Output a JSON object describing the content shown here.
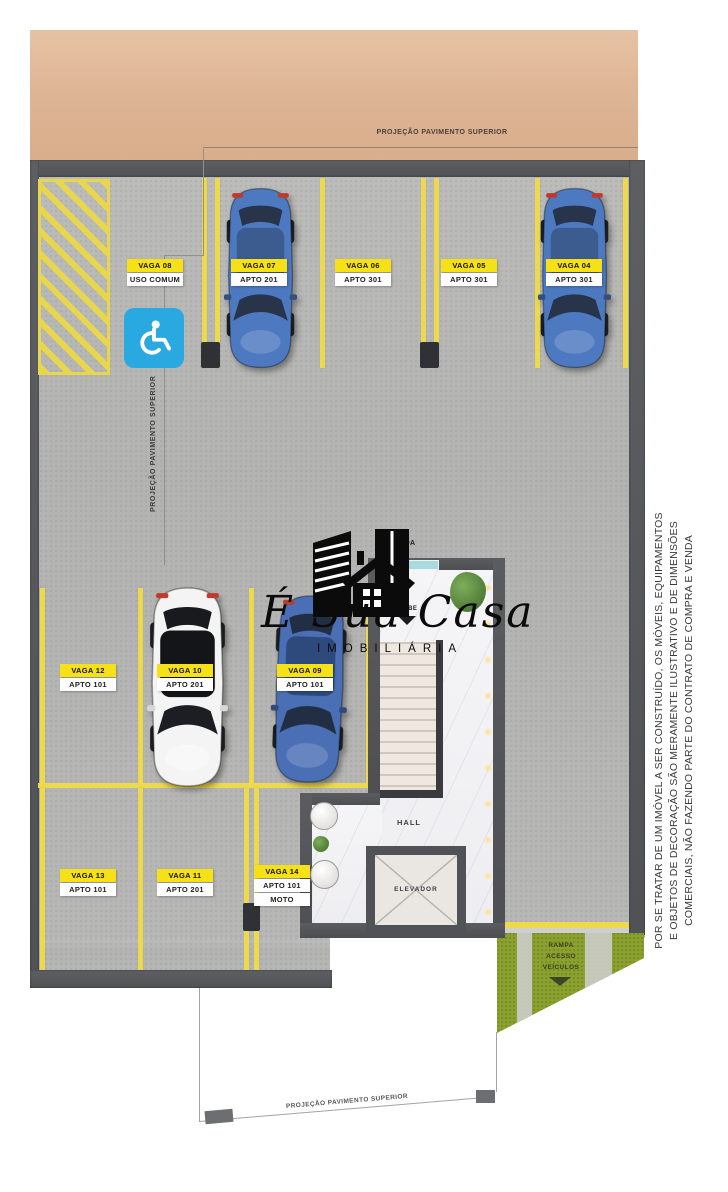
{
  "palette": {
    "sidewalk_tan": "#ddb493",
    "floor_gray": "#b6b7b5",
    "wall_gray": "#55565a",
    "paint_yellow": "#ecd94d",
    "label_yellow": "#f6e016",
    "accessible_blue": "#2aa9e1",
    "ramp_green": "#8ba22e",
    "car_blue": "#4d79c0",
    "car_white": "#f4f4f4"
  },
  "annotations": {
    "top_projection_label": "PROJEÇÃO PAVIMENTO SUPERIOR",
    "left_projection_label": "PROJEÇÃO PAVIMENTO SUPERIOR",
    "bottom_projection_label": "PROJEÇÃO PAVIMENTO SUPERIOR"
  },
  "parking": {
    "top_row": [
      {
        "vaga": "VAGA 08",
        "unit": "USO COMUM"
      },
      {
        "vaga": "VAGA 07",
        "unit": "APTO 201"
      },
      {
        "vaga": "VAGA 06",
        "unit": "APTO 301"
      },
      {
        "vaga": "VAGA 05",
        "unit": "APTO 301"
      },
      {
        "vaga": "VAGA 04",
        "unit": "APTO 301"
      }
    ],
    "middle_row": [
      {
        "vaga": "VAGA 12",
        "unit": "APTO 101"
      },
      {
        "vaga": "VAGA 10",
        "unit": "APTO 201"
      },
      {
        "vaga": "VAGA 09",
        "unit": "APTO 101"
      }
    ],
    "bottom_row": [
      {
        "vaga": "VAGA 13",
        "unit": "APTO 101"
      },
      {
        "vaga": "VAGA 11",
        "unit": "APTO 201"
      },
      {
        "vaga": "VAGA 14",
        "unit": "APTO 101",
        "extra": "MOTO"
      }
    ]
  },
  "interior": {
    "entrance": "ENTRADA",
    "stairs_up": "SOBE",
    "hall": "HALL",
    "elevator": "ELEVADOR"
  },
  "ramp": {
    "line1": "RAMPA",
    "line2": "ACESSO",
    "line3": "VEÍCULOS"
  },
  "watermark": {
    "script": "É Sua Casa",
    "subtitle": "IMOBILIÁRIA"
  },
  "disclaimer": {
    "line1": "POR SE TRATAR DE UM IMÓVEL A SER CONSTRUÍDO, OS MÓVEIS, EQUIPAMENTOS",
    "line2": "E OBJETOS DE DECORAÇÃO SÃO MERAMENTE ILUSTRATIVO E DE DIMENSÕES",
    "line3": "COMERCIAIS, NÃO FAZENDO PARTE DO CONTRATO DE COMPRA E VENDA"
  }
}
